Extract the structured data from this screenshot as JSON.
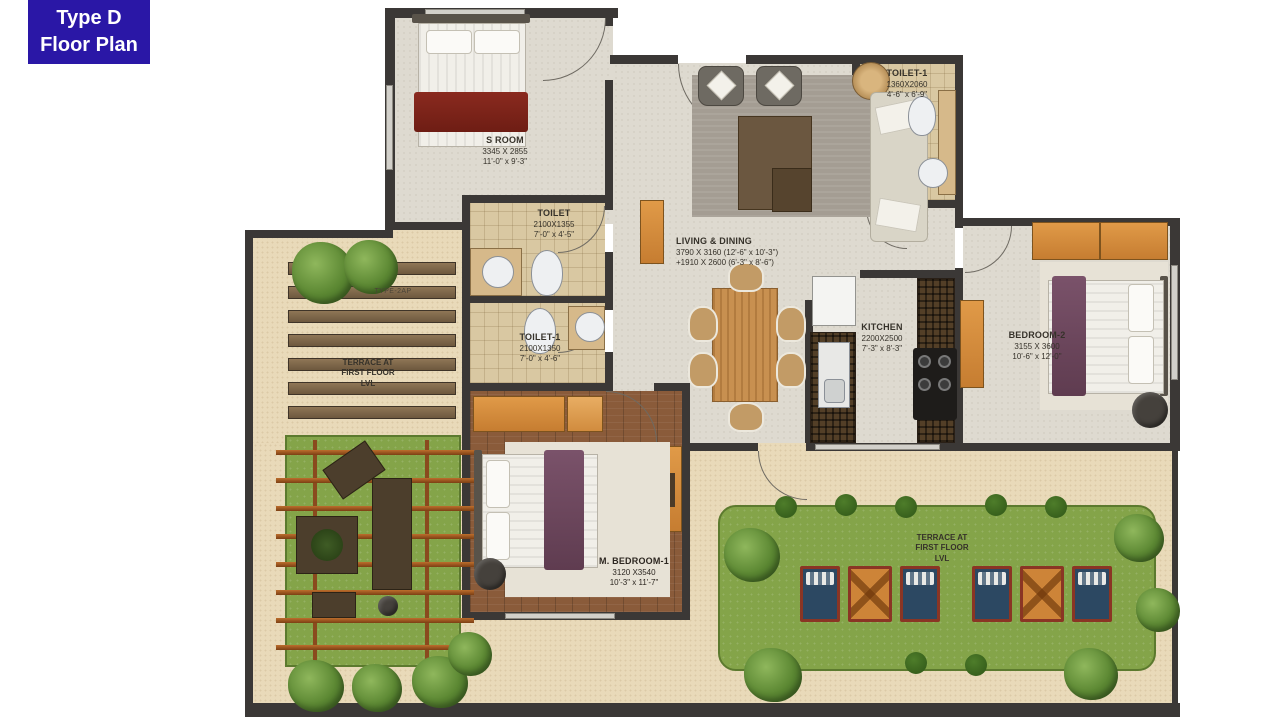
{
  "title_badge": {
    "line1": "Type D",
    "line2": "Floor Plan"
  },
  "rooms": {
    "s_room": {
      "name": "S ROOM",
      "dims_mm": "3345 X 2855",
      "dims_ft": "11'-0\" x 9'-3\""
    },
    "toilet1_top": {
      "name": "TOILET-1",
      "dims_mm": "1360X2060",
      "dims_ft": "4'-6\" x 6'-9\""
    },
    "toilet_mid": {
      "name": "TOILET",
      "dims_mm": "2100X1355",
      "dims_ft": "7'-0\" x 4'-5\""
    },
    "toilet1_mid": {
      "name": "TOILET-1",
      "dims_mm": "2100X1350",
      "dims_ft": "7'-0\" x 4'-6\""
    },
    "living_dining": {
      "name": "LIVING & DINING",
      "dims_line1": "3790 X 3160 (12'-6\" x 10'-3\")",
      "dims_line2": "+1910 X 2600 (6'-3\" x 8'-6\")"
    },
    "kitchen": {
      "name": "KITCHEN",
      "dims_mm": "2200X2500",
      "dims_ft": "7'-3\" x 8'-3\""
    },
    "bedroom_2": {
      "name": "BEDROOM-2",
      "dims_mm": "3155 X 3600",
      "dims_ft": "10'-6\" x 12'-0\""
    },
    "m_bedroom_1": {
      "name": "M. BEDROOM-1",
      "dims_mm": "3120 X3540",
      "dims_ft": "10'-3\" x 11'-7\""
    }
  },
  "terraces": {
    "left": {
      "line1": "TERRACE AT",
      "line2": "FIRST FLOOR",
      "line3": "LVL",
      "code": "TYPE-2AP"
    },
    "right": {
      "line1": "TERRACE AT",
      "line2": "FIRST FLOOR",
      "line3": "LVL"
    }
  },
  "colors": {
    "badge_bg": "#2a17a6",
    "badge_fg": "#ffffff",
    "wall": "#3b3836",
    "terrace_beige": "#e9dab9",
    "floor_light": "#dedad0",
    "floor_toilet": "#d9c8a2",
    "floor_wood": "#8a5b3a",
    "lawn_green": "#84a449",
    "furniture_orange": "#d8913f",
    "blanket_maroon": "#7c241b",
    "blanket_plum": "#6e4559",
    "seat_blue": "#2c4862",
    "seat_orange": "#cd8438",
    "pergola_beam": "#b4672a"
  }
}
